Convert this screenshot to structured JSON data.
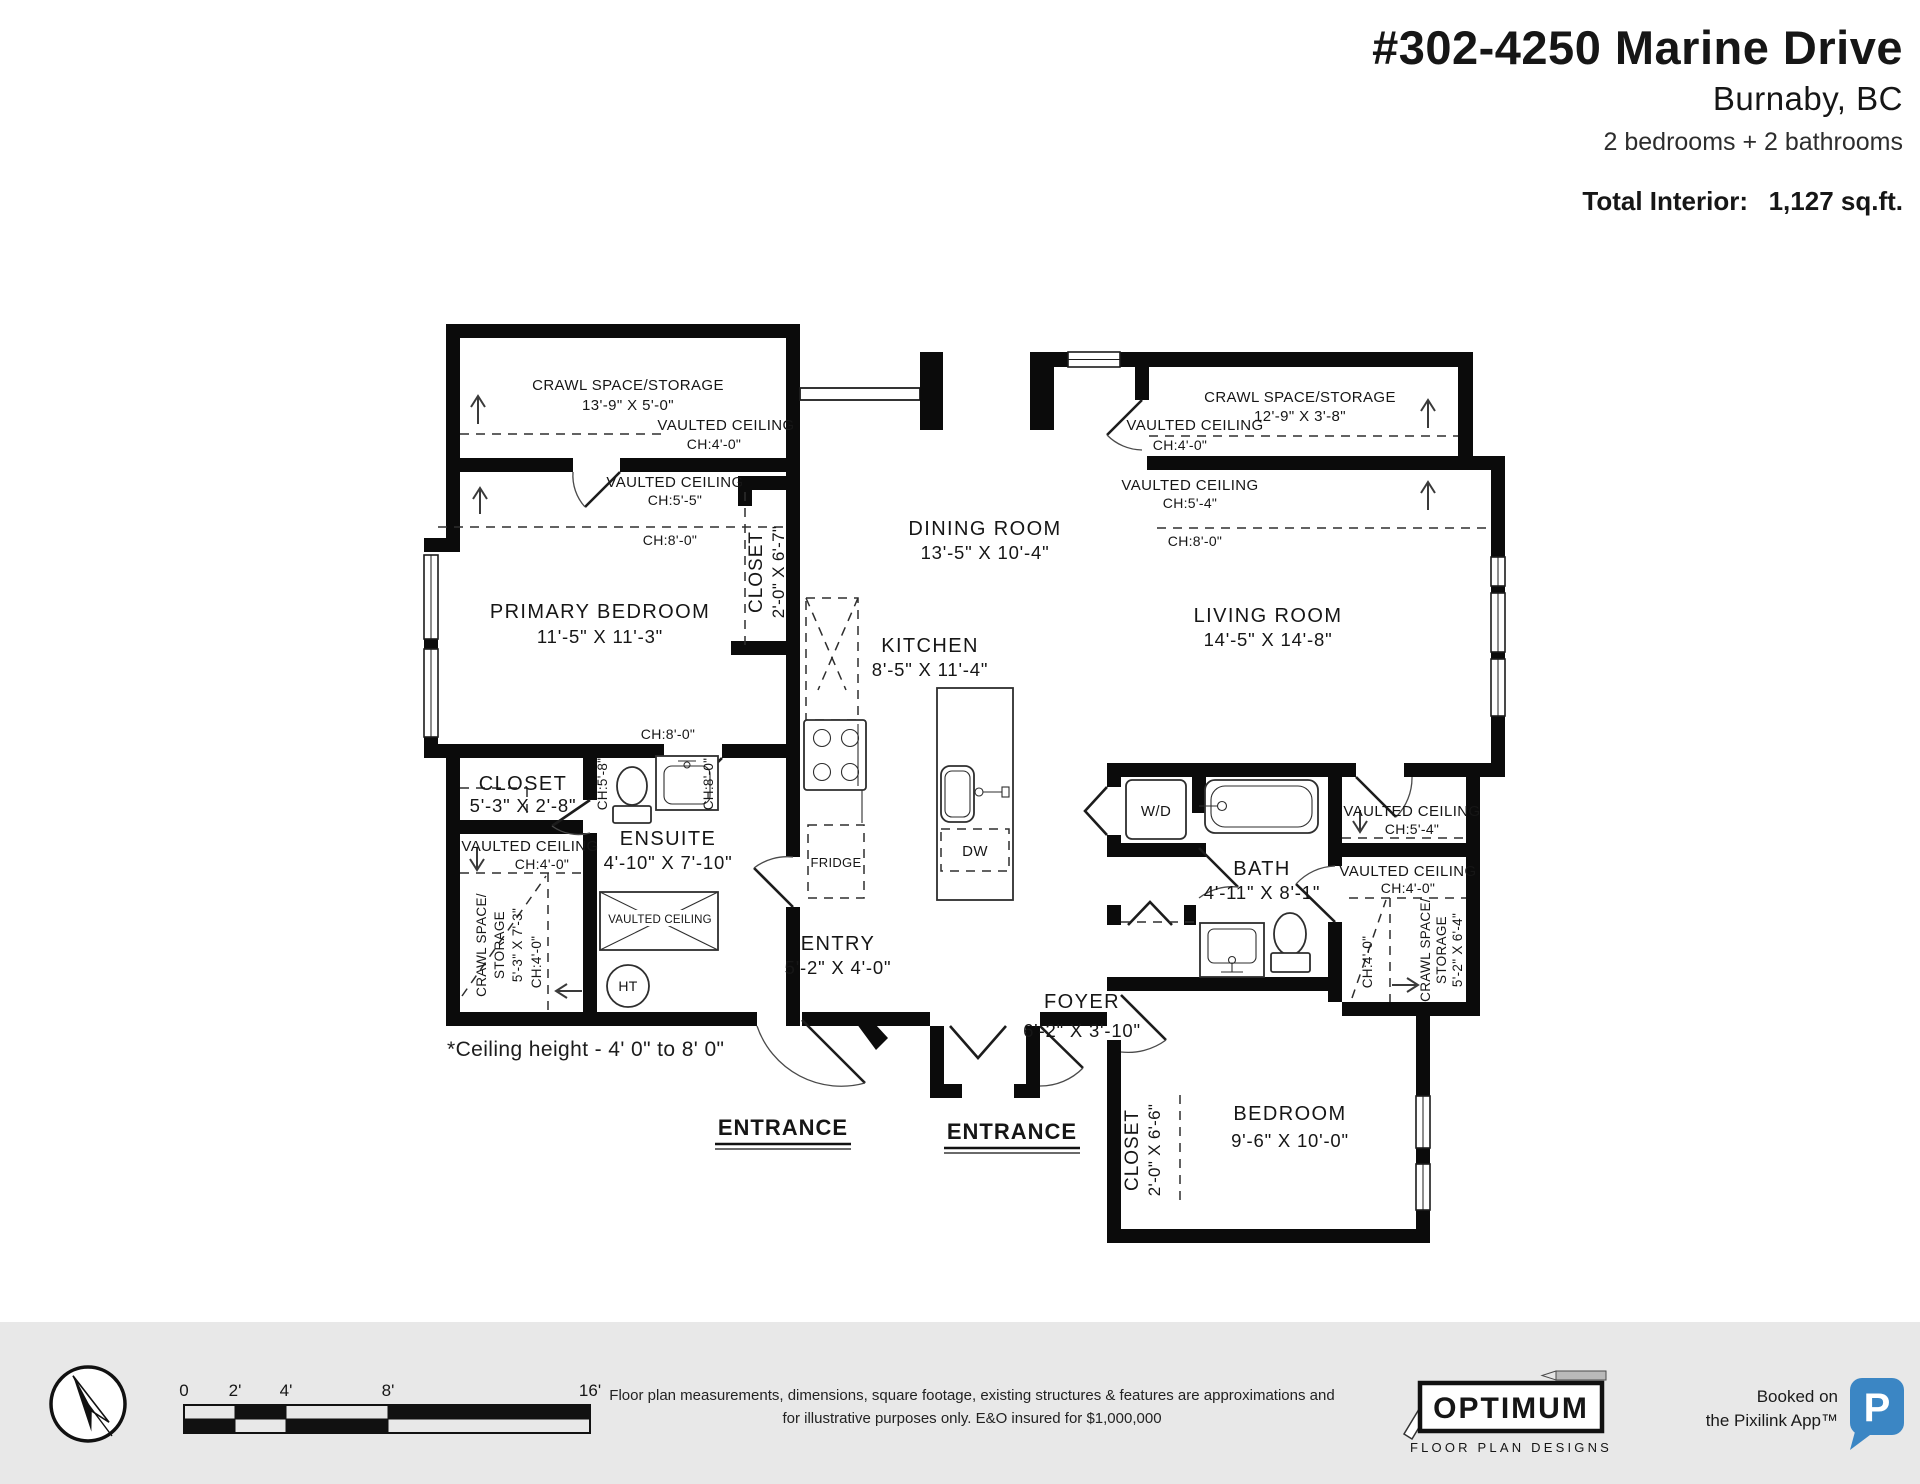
{
  "header": {
    "address_line1": "#302-4250 Marine Drive",
    "address_line2": "Burnaby, BC",
    "summary": "2 bedrooms + 2 bathrooms",
    "total_label": "Total Interior:",
    "total_value": "1,127 sq.ft."
  },
  "plan": {
    "crawl_tl": {
      "name": "CRAWL SPACE/STORAGE",
      "dims": "13'-9\" X 5'-0\""
    },
    "vaulted_tl": {
      "line1": "VAULTED CEILING",
      "line2": "CH:4'-0\""
    },
    "vaulted_pb": {
      "line1": "VAULTED CEILING",
      "line2": "CH:5'-5\""
    },
    "primary_bedroom": {
      "ch_upper": "CH:8'-0\"",
      "name": "PRIMARY BEDROOM",
      "dims": "11'-5\" X 11'-3\"",
      "ch_lower": "CH:8'-0\""
    },
    "closet_hall": {
      "name": "CLOSET",
      "dims": "2'-0\" X 6'-7\""
    },
    "dining": {
      "name": "DINING ROOM",
      "dims": "13'-5\" X 10'-4\""
    },
    "kitchen": {
      "name": "KITCHEN",
      "dims": "8'-5\" X 11'-4\"",
      "fridge": "FRIDGE",
      "dw": "DW"
    },
    "crawl_tr": {
      "name": "CRAWL SPACE/STORAGE",
      "dims": "12'-9\" X 3'-8\""
    },
    "vaulted_tr_upper": {
      "line1": "VAULTED CEILING",
      "line2": "CH:4'-0\""
    },
    "vaulted_tr_lower": {
      "line1": "VAULTED CEILING",
      "line2": "CH:5'-4\""
    },
    "living": {
      "ch": "CH:8'-0\"",
      "name": "LIVING ROOM",
      "dims": "14'-5\" X 14'-8\""
    },
    "closet_pb": {
      "name": "CLOSET",
      "dims": "5'-3\" X 2'-8\""
    },
    "ensuite": {
      "name": "ENSUITE",
      "dims": "4'-10\" X 7'-10\"",
      "ch_left": "CH:5'-8\"",
      "ch_right": "CH:8'-0\"",
      "hatch_label": "VAULTED CEILING"
    },
    "crawl_bl": {
      "vc_line1": "VAULTED CEILING",
      "vc_line2": "CH:4'-0\"",
      "line1": "CRAWL SPACE/",
      "line2": "STORAGE",
      "line3": "5'-3\" X 7'-3\"",
      "ch": "CH:4'-0\""
    },
    "ht_label": "HT",
    "wd_label": "W/D",
    "entry": {
      "name": "ENTRY",
      "dims": "5'-2\" X 4'-0\""
    },
    "foyer": {
      "name": "FOYER",
      "dims": "6'-2\" X 3'-10\""
    },
    "bath": {
      "name": "BATH",
      "dims": "4'-11\" X 8'-1\""
    },
    "vaulted_br_upper": {
      "line1": "VAULTED CEILING",
      "line2": "CH:5'-4\""
    },
    "vaulted_br_lower": {
      "line1": "VAULTED CEILING",
      "line2": "CH:4'-0\""
    },
    "crawl_br": {
      "line1": "CRAWL SPACE/",
      "line2": "STORAGE",
      "line3": "5'-2\" X 6'-4\"",
      "ch": "CH:4'-0\""
    },
    "bedroom": {
      "name": "BEDROOM",
      "dims": "9'-6\" X 10'-0\""
    },
    "closet_br": {
      "name": "CLOSET",
      "dims": "2'-0\" X 6'-6\""
    },
    "entrance_left": "ENTRANCE",
    "entrance_right": "ENTRANCE",
    "note": "*Ceiling height - 4' 0\" to 8' 0\""
  },
  "footer": {
    "scale_labels": [
      "0",
      "2'",
      "4'",
      "8'",
      "16'"
    ],
    "disclaimer_line1": "Floor plan measurements, dimensions, square footage, existing structures & features are approximations and",
    "disclaimer_line2": "for illustrative purposes only.  E&O insured for $1,000,000",
    "brand_name": "OPTIMUM",
    "brand_tagline": "FLOOR PLAN DESIGNS",
    "booked_line1": "Booked on",
    "booked_line2": "the Pixilink App™",
    "app_letter": "P",
    "app_color": "#3b86c4"
  }
}
